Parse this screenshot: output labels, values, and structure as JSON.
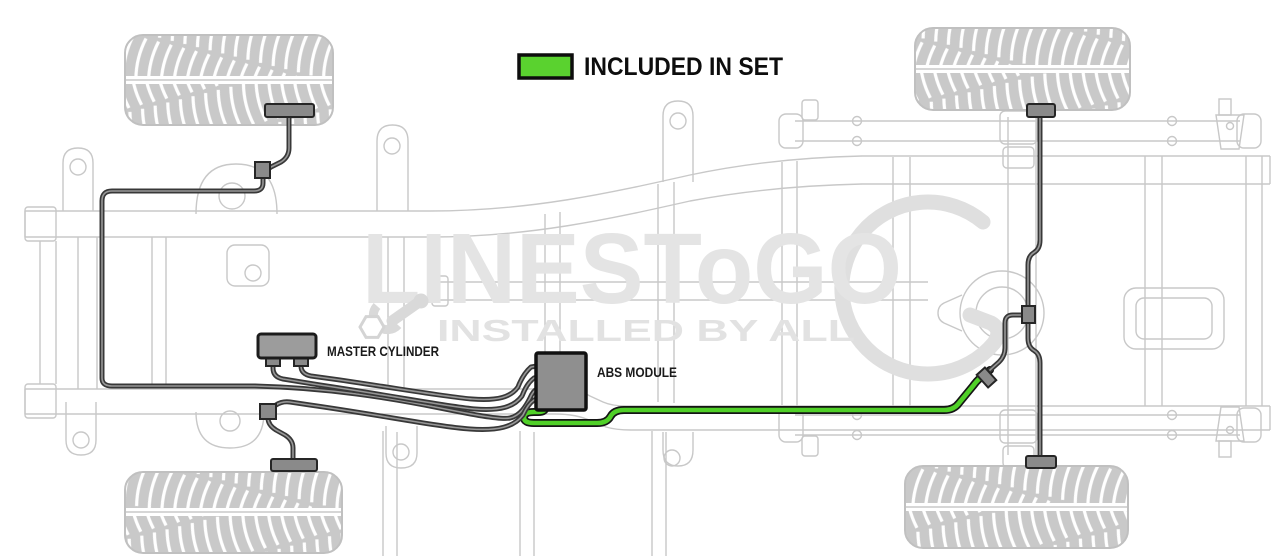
{
  "legend": {
    "label": "INCLUDED IN SET",
    "swatch_color": "#5ad22f"
  },
  "components": {
    "master_cylinder": "MASTER CYLINDER",
    "abs_module": "ABS MODULE"
  },
  "watermark": {
    "brand": "LINESToGO",
    "tagline": "INSTALLED BY ALL"
  },
  "colors": {
    "included_line": "#50d028",
    "brake_line": "#383838",
    "chassis_outline": "#c8c8c8"
  }
}
